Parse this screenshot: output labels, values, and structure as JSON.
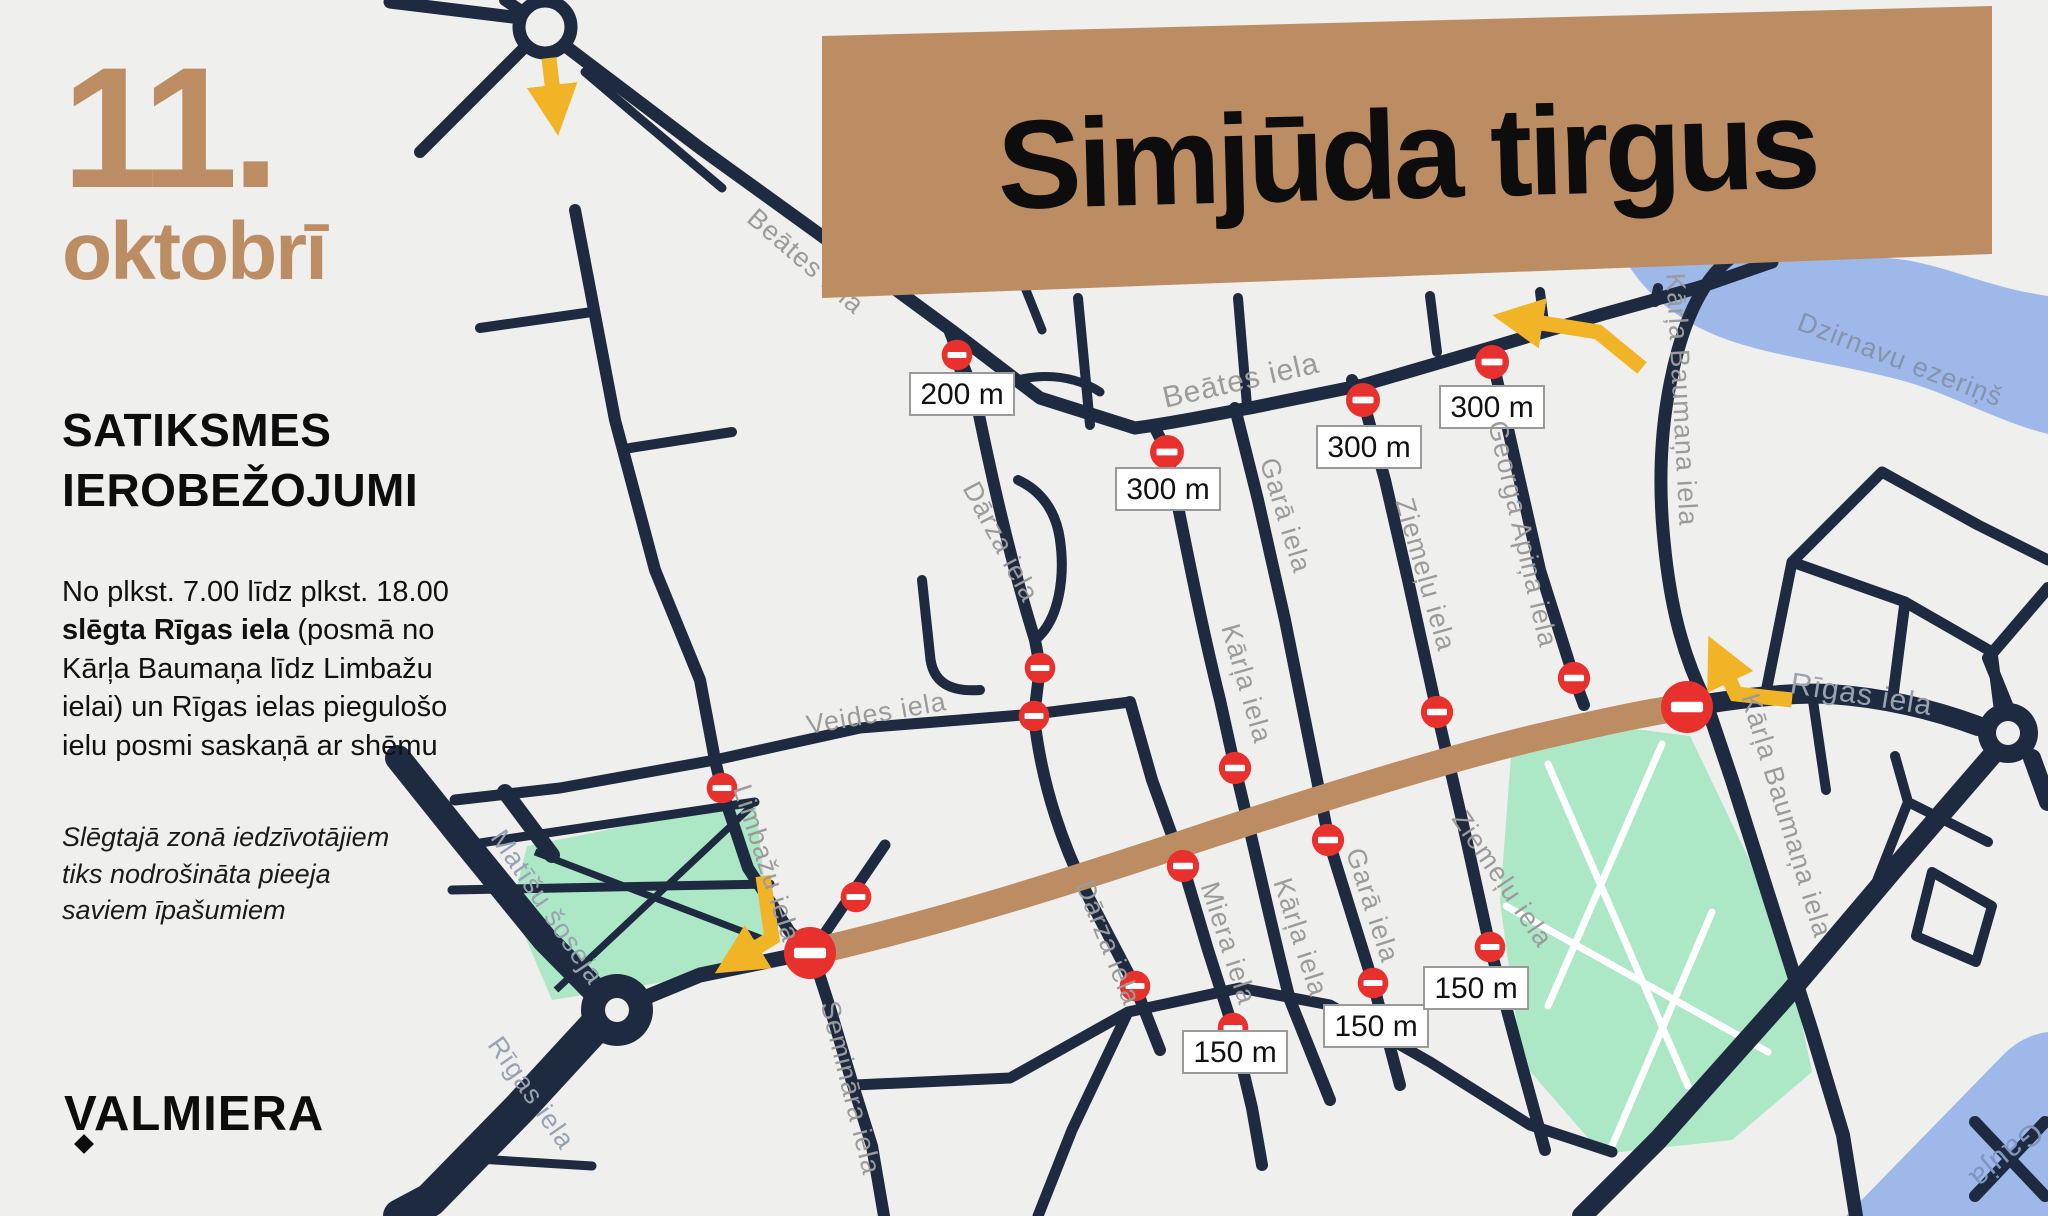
{
  "poster": {
    "date_line1": "11.",
    "date_line2": "oktobrī",
    "heading_line1": "SATIKSMES",
    "heading_line2": "IEROBEŽOJUMI",
    "body_before_bold": "No plkst. 7.00 līdz plkst. 18.00 ",
    "body_bold": "slēgta Rīgas iela",
    "body_after_bold": " (posmā no Kārļa Baumaņa līdz Limbažu ielai) un Rīgas ielas piegulošo ielu posmi saskaņā ar shēmu",
    "note": "Slēgtajā zonā iedzīvotājiem tiks nodrošināta pieeja saviem īpašumiem",
    "logo_text": "VALMIERA",
    "title": "Simjūda tirgus"
  },
  "map": {
    "street_labels": [
      {
        "text": "Beātes iela"
      },
      {
        "text": "Beātes iela"
      },
      {
        "text": "Dārza iela"
      },
      {
        "text": "Garā iela"
      },
      {
        "text": "Ziemeļu iela"
      },
      {
        "text": "Georga Apiņa iela"
      },
      {
        "text": "Kārļa Baumaņa iela"
      },
      {
        "text": "Veides iela"
      },
      {
        "text": "Limbažu iela"
      },
      {
        "text": "Matīšu šoseja"
      },
      {
        "text": "Rīgas iela"
      },
      {
        "text": "Semināra iela"
      },
      {
        "text": "Kārļa iela"
      },
      {
        "text": "Dārza iela"
      },
      {
        "text": "Miera iela"
      },
      {
        "text": "Kārļa iela"
      },
      {
        "text": "Garā iela"
      },
      {
        "text": "Ziemeļu iela"
      },
      {
        "text": "Kārļa Baumaņa iela"
      },
      {
        "text": "Rīgas iela"
      },
      {
        "text": "Dzirnavu ezeriņš"
      },
      {
        "text": "Gauja"
      }
    ],
    "distance_badges": [
      {
        "label": "200 m"
      },
      {
        "label": "300 m"
      },
      {
        "label": "300 m"
      },
      {
        "label": "300 m"
      },
      {
        "label": "150 m"
      },
      {
        "label": "150 m"
      },
      {
        "label": "150 m"
      }
    ],
    "colors": {
      "brown": "#BC8C62",
      "navy": "#1D2A40",
      "red": "#E8312D",
      "yellow": "#F2B427",
      "green": "#ACE8C6",
      "water": "#9DB8E9",
      "bg": "#EFEFED",
      "labelgray": "#9B9B9B"
    }
  }
}
